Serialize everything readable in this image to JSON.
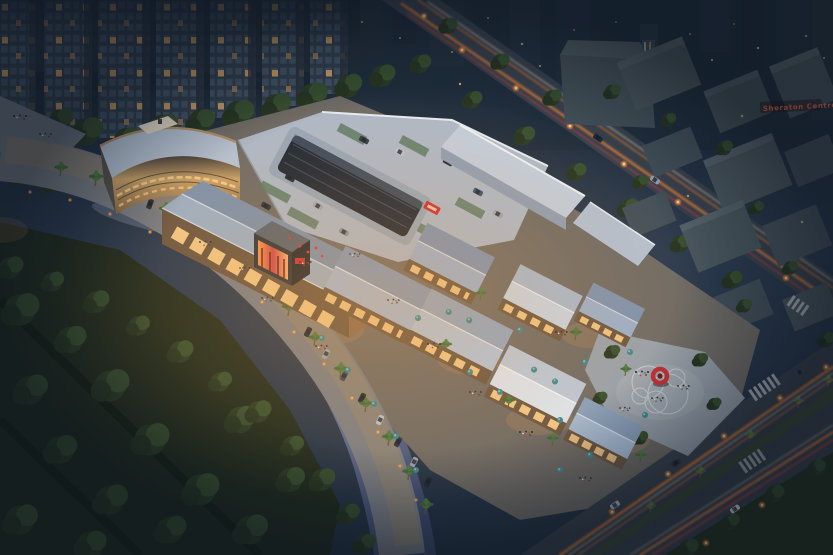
{
  "signs": {
    "sheraton": "Sheraton Centre"
  },
  "palette": {
    "sky_top": "#18222e",
    "sky_mid": "#2b3b50",
    "tower_facade": "#323f4e",
    "tower_window": "#445567",
    "window_lit": "#e2a964",
    "tree_dark": "#2b3a26",
    "tree_mid": "#38502f",
    "park_ground": "#202b1d",
    "river_light": "#a9b2d6",
    "river_mid": "#7c87b4",
    "river_dark": "#3c4a6e",
    "promenade": "#7b7f86",
    "roof_deck": "#aeb9c9",
    "skylight_glass": "#1c2634",
    "roof_blue": "#9db0c6",
    "roof_blue_dark": "#7c92ad",
    "roof_white": "#dde6f0",
    "facade_warm": "#caa36a",
    "storefront_glow": "#ffd28c",
    "road": "#3a424d",
    "trail_orange": "#ff8a38",
    "trail_white": "#ffeccc",
    "trail_red": "#ff4a3a",
    "umbrella": "#3e868f",
    "palm_green": "#4e7c40",
    "sculpture_red": "#c32f36",
    "lamp": "#ff9a3c",
    "plaza": "#99a2ac",
    "parking_green": "#5c7a66",
    "block_gray": "#4b585f",
    "sign_red": "#ff6a50"
  }
}
